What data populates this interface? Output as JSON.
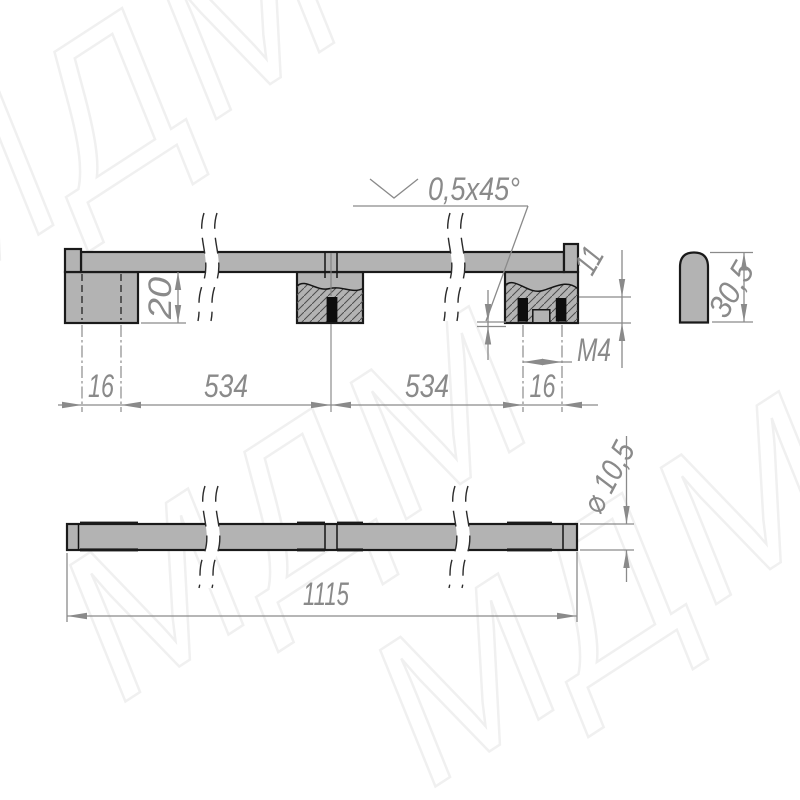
{
  "drawing": {
    "watermark_text": "МДМ",
    "section_view": {
      "chamfer_note": "0,5x45°",
      "foot_height": "20",
      "left_hole_spacing": "16",
      "span_left": "534",
      "span_right": "534",
      "right_hole_spacing": "16",
      "hole_depth": "11",
      "thread_label": "M4",
      "profile_height": "30,5"
    },
    "plan_view": {
      "bar_diameter": "⌀ 10,5",
      "total_length": "1115"
    },
    "colors": {
      "part_fill": "#b3b3b3",
      "part_outline": "#1a1a1a",
      "dimension_gray": "#8a8a8a",
      "hole_fill": "#0d0d0d",
      "watermark": "#f0f0f0"
    }
  }
}
